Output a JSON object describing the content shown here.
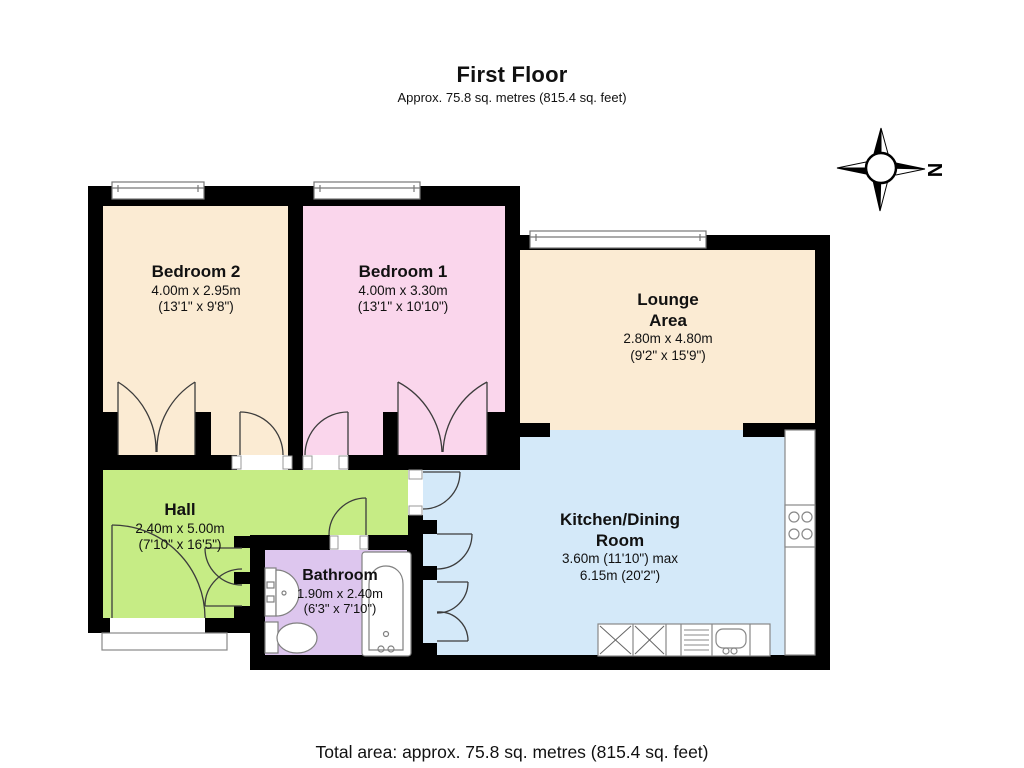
{
  "header": {
    "title": "First Floor",
    "subtitle": "Approx.  75.8 sq. metres (815.4 sq. feet)"
  },
  "footer": {
    "total_area": "Total area: approx.  75.8 sq. metres (815.4 sq. feet)"
  },
  "compass": {
    "north_label": "N"
  },
  "rooms": [
    {
      "name": "Bedroom 2",
      "dims_metric": "4.00m x 2.95m",
      "dims_imperial": "(13'1\" x 9'8\")"
    },
    {
      "name": "Bedroom 1",
      "dims_metric": "4.00m x 3.30m",
      "dims_imperial": "(13'1\" x 10'10\")"
    },
    {
      "name_line1": "Lounge",
      "name_line2": "Area",
      "dims_metric": "2.80m x 4.80m",
      "dims_imperial": "(9'2\" x 15'9\")"
    },
    {
      "name": "Hall",
      "dims_metric": "2.40m x 5.00m",
      "dims_imperial": "(7'10\" x 16'5\")"
    },
    {
      "name": "Bathroom",
      "dims_metric": "1.90m x 2.40m",
      "dims_imperial": "(6'3\" x 7'10\")"
    },
    {
      "name_line1": "Kitchen/Dining",
      "name_line2": "Room",
      "dims_metric": "3.60m (11'10\") max",
      "dims_imperial": "6.15m (20'2\")"
    }
  ],
  "palette": {
    "bedroom2": "#FBEBD3",
    "bedroom1": "#FAD6EC",
    "lounge": "#FBEBD3",
    "hall": "#C6EC85",
    "bathroom": "#DDC6EE",
    "kitchen": "#D4E9F9",
    "walls": "#000000"
  }
}
